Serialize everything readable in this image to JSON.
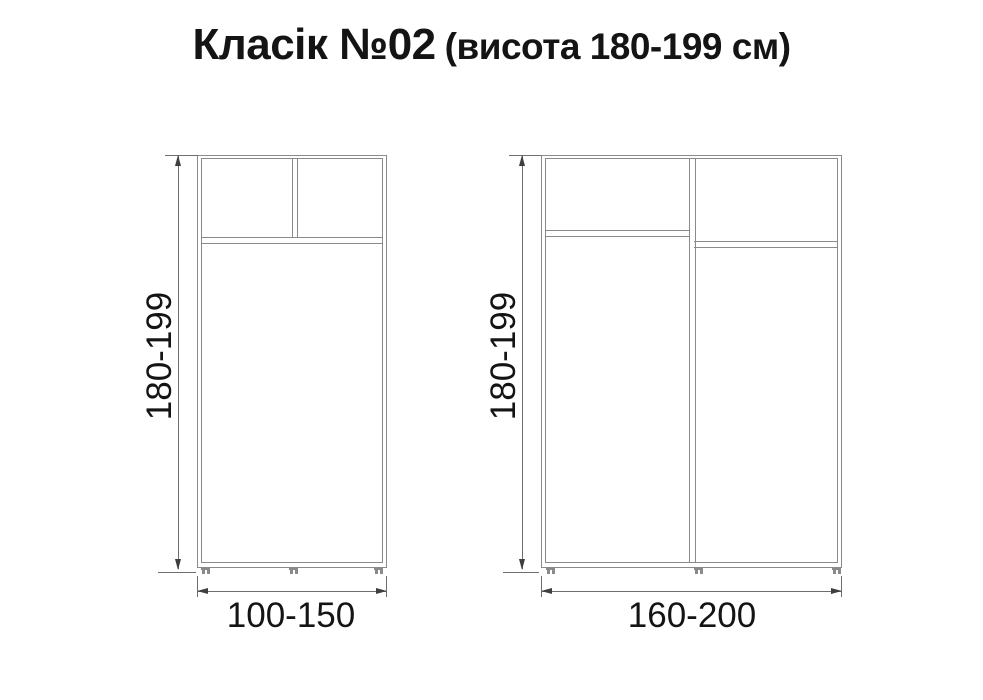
{
  "title": {
    "main": "Класік №02",
    "sub": "(висота 180-199 см)"
  },
  "diagrams": [
    {
      "id": "small-wardrobe",
      "type": "wardrobe-front-view-2-sections",
      "height_label": "180-199",
      "width_label": "100-150"
    },
    {
      "id": "large-wardrobe",
      "type": "wardrobe-front-view-3-sections",
      "height_label": "180-199",
      "width_label": "160-200"
    }
  ],
  "colors": {
    "background": "#ffffff",
    "furniture_line": "#8a8a8a",
    "dimension_line": "#6e6e6e",
    "arrow": "#3f3f3f",
    "text": "#141414"
  }
}
